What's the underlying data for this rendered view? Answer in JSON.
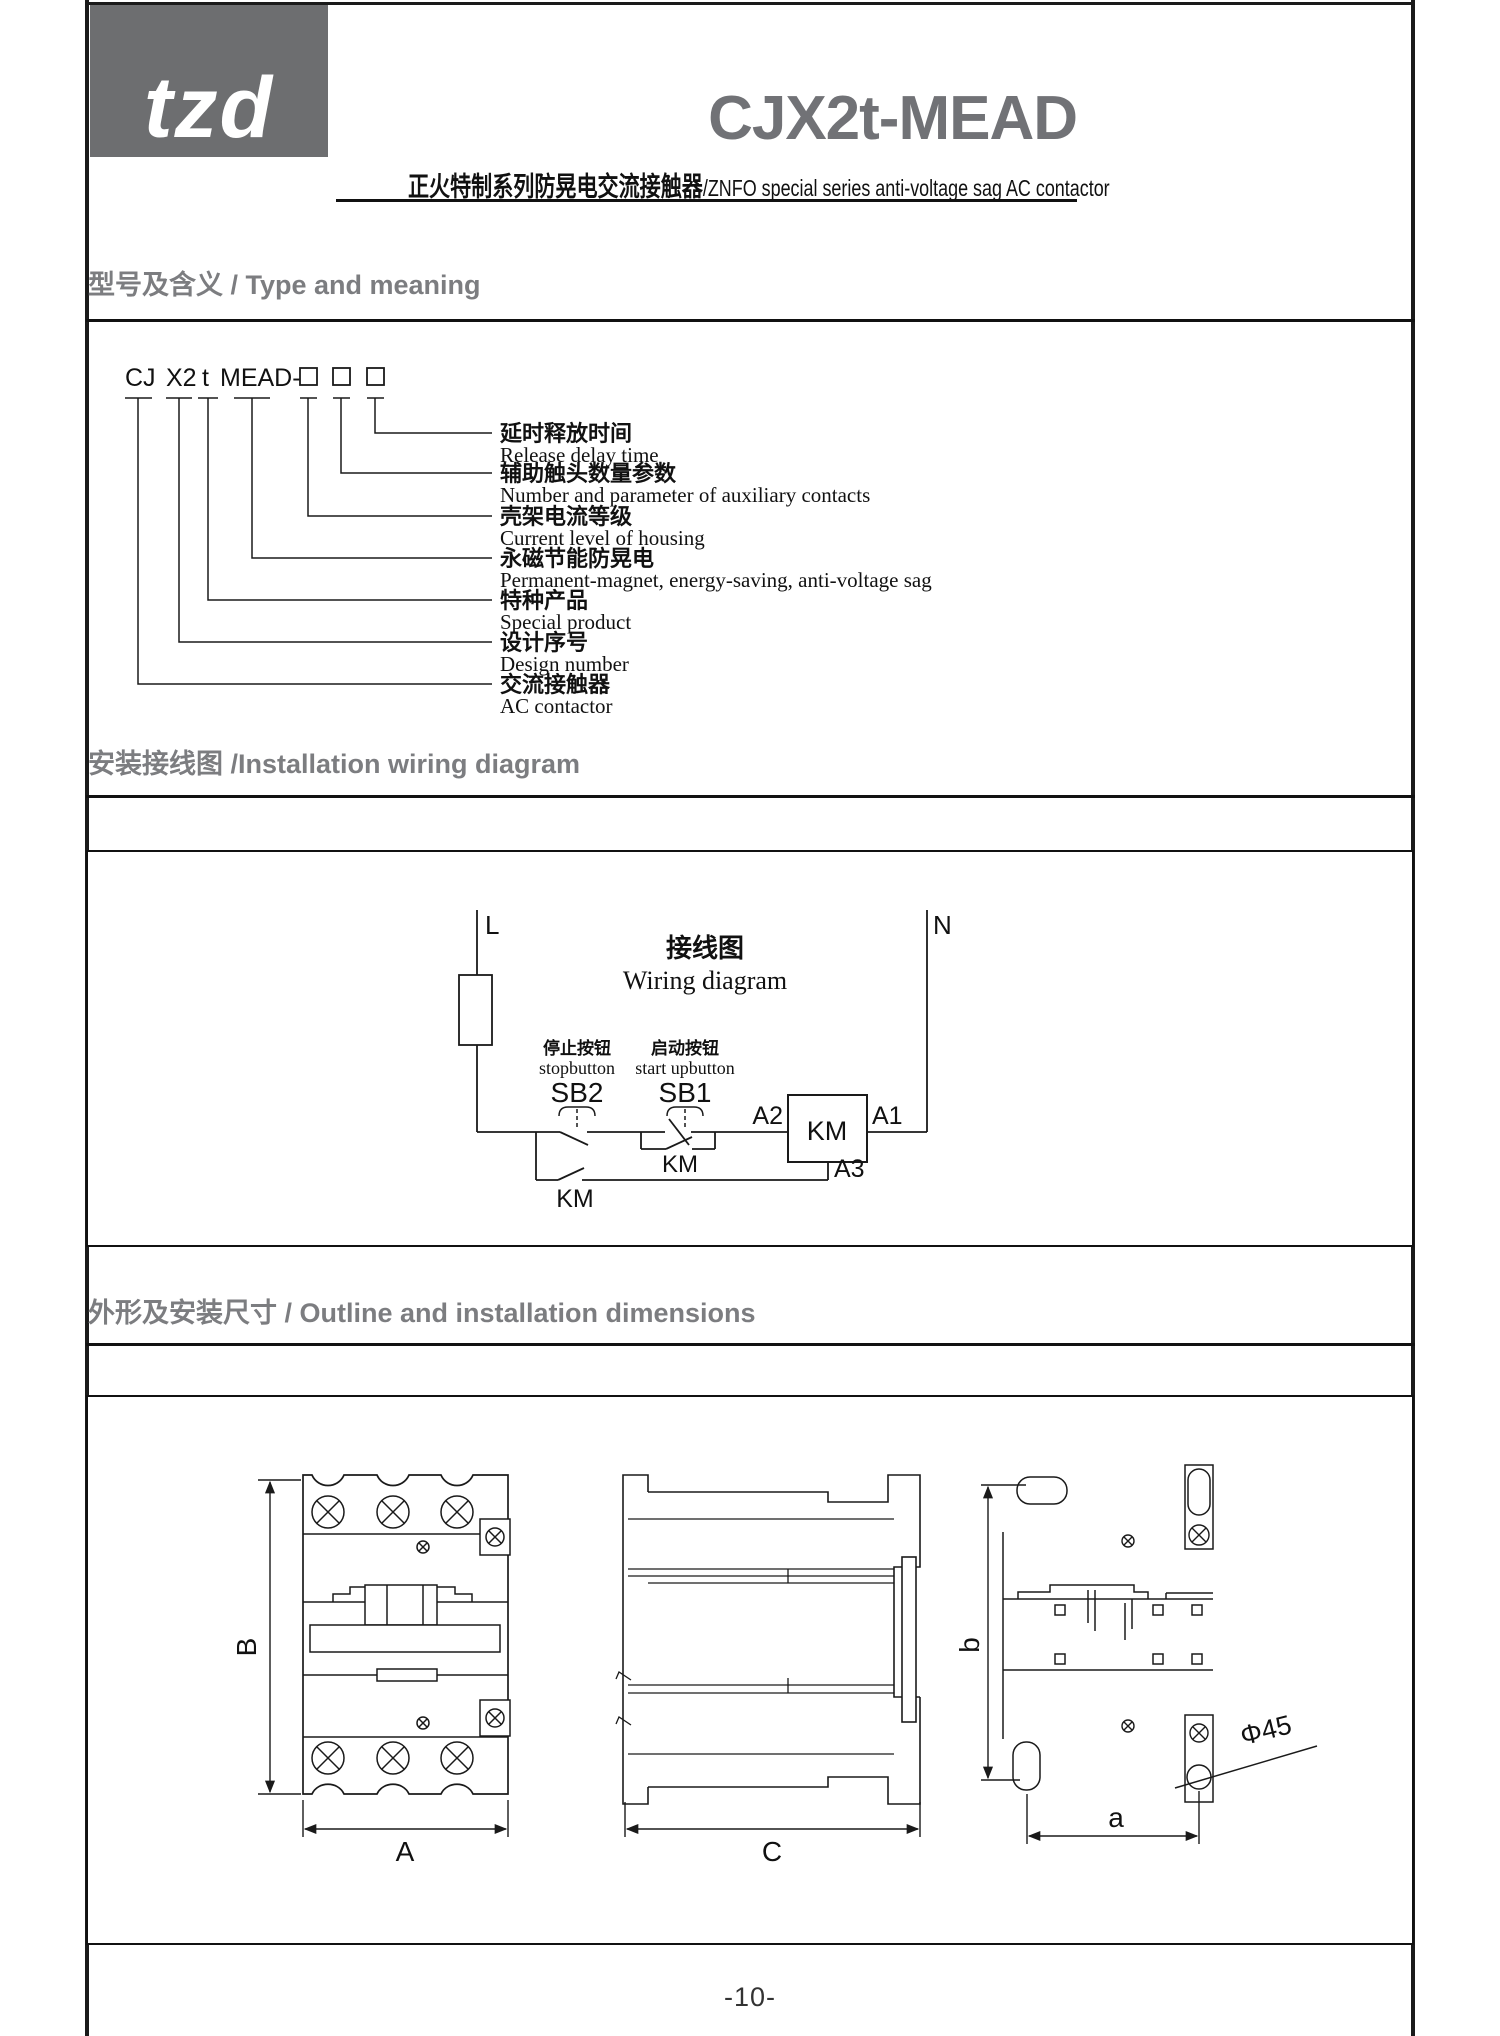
{
  "header": {
    "logo_text": "tzd",
    "product_model": "CJX2t-MEAD",
    "subtitle_cn": "正火特制系列防晃电交流接触器",
    "subtitle_en": "/ZNFO special series anti-voltage sag AC contactor"
  },
  "type_section": {
    "title": "型号及含义 / Type and meaning",
    "code": {
      "parts": [
        "CJ",
        "X2",
        "t",
        "MEAD-"
      ],
      "placeholder_boxes": 3
    },
    "labels": [
      {
        "cn": "延时释放时间",
        "en": "Release delay time"
      },
      {
        "cn": "辅助触头数量参数",
        "en": "Number and parameter of auxiliary contacts"
      },
      {
        "cn": "壳架电流等级",
        "en": "Current level of housing"
      },
      {
        "cn": "永磁节能防晃电",
        "en": "Permanent-magnet, energy-saving, anti-voltage sag"
      },
      {
        "cn": "特种产品",
        "en": "Special product"
      },
      {
        "cn": "设计序号",
        "en": "Design number"
      },
      {
        "cn": "交流接触器",
        "en": "AC contactor"
      }
    ]
  },
  "wiring_section": {
    "title": "安装接线图 /Installation wiring diagram",
    "phase_label": "L",
    "neutral_label": "N",
    "diagram_title_cn": "接线图",
    "diagram_title_en": "Wiring diagram",
    "stop_button_cn": "停止按钮",
    "stop_button_en": "stopbutton",
    "stop_button_id": "SB2",
    "start_button_cn": "启动按钮",
    "start_button_en": "start upbutton",
    "start_button_id": "SB1",
    "terminal_a2": "A2",
    "coil_label": "KM",
    "terminal_a1": "A1",
    "terminal_a3": "A3",
    "hold_contact_label": "KM",
    "latch_contact_label": "KM"
  },
  "outline_section": {
    "title": "外形及安装尺寸 / Outline and installation dimensions",
    "dim_height_label": "B",
    "dim_width_label": "A",
    "dim_depth_label": "C",
    "dim_mount_height_label": "b",
    "dim_mount_width_label": "a",
    "hole_label": "Φ45"
  },
  "footer": {
    "page_number": "-10-"
  },
  "colors": {
    "brand_gray": "#6d6e70",
    "title_gray": "#717276",
    "heading_gray": "#7c7d80",
    "line_black": "#1a1a1a"
  }
}
